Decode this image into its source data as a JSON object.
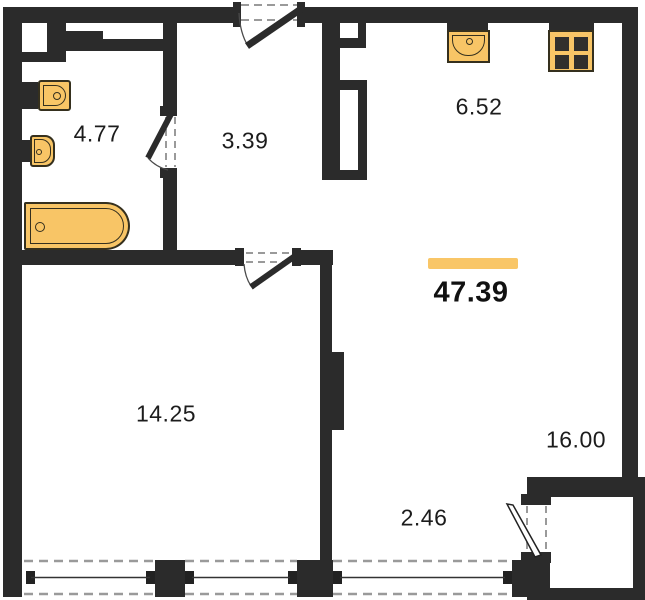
{
  "total": {
    "area": "47.39"
  },
  "rooms": {
    "bathroom": {
      "area": "4.77"
    },
    "hallway": {
      "area": "3.39"
    },
    "kitchen": {
      "area": "6.52"
    },
    "bedroom": {
      "area": "14.25"
    },
    "living": {
      "area": "16.00"
    },
    "balcony": {
      "area": "2.46"
    }
  },
  "fixtures": {
    "bathroom_sink": "wash-basin",
    "toilet": "toilet",
    "bathtub": "bathtub",
    "kitchen_sink": "kitchen-sink",
    "stove": "four-burner-stove"
  },
  "colors": {
    "wall": "#2b2b2b",
    "fixture": "#f8c566",
    "fixture_line": "#35301e",
    "accent": "#f9c667",
    "window_dash": "#9a9a9a",
    "text": "#1c1c1c"
  }
}
